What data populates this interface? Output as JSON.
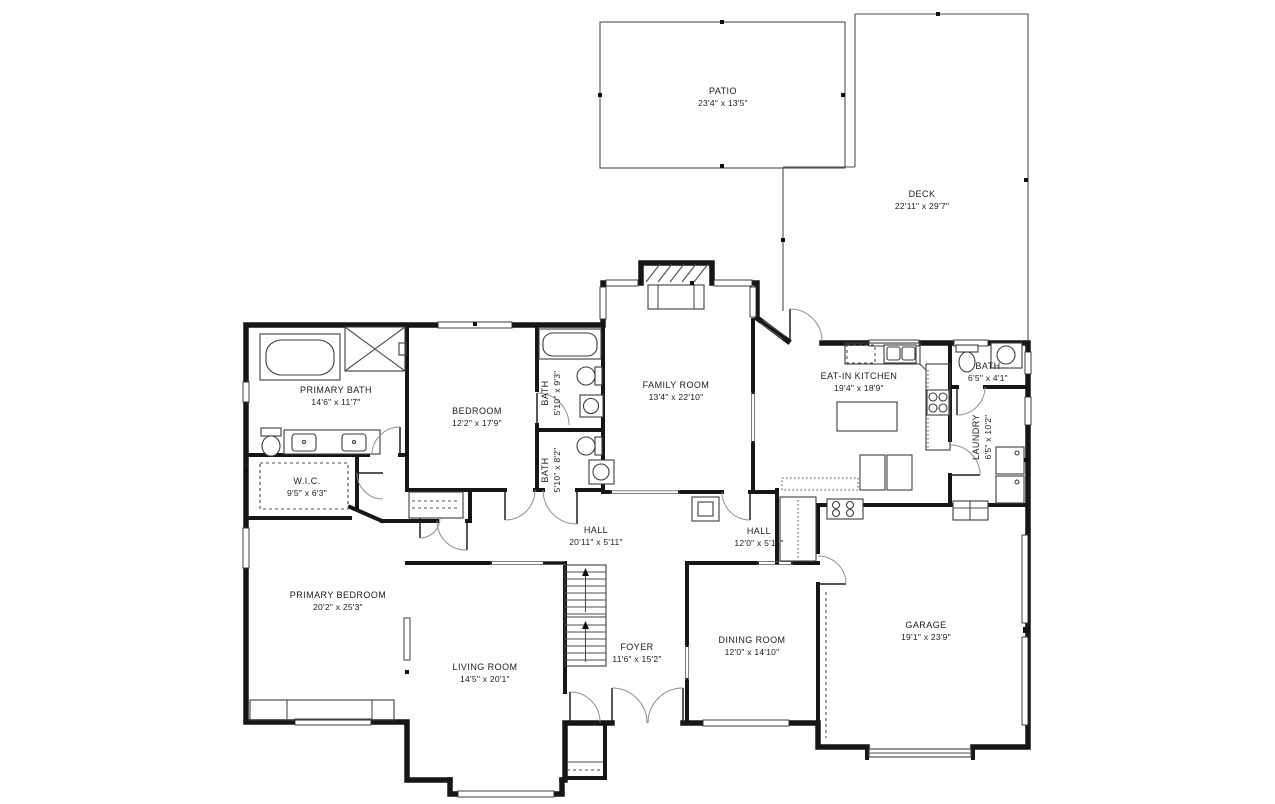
{
  "rooms": {
    "patio": {
      "name": "PATIO",
      "dims": "23'4\" x 13'5\""
    },
    "deck": {
      "name": "DECK",
      "dims": "22'11\" x 29'7\""
    },
    "primary_bath": {
      "name": "PRIMARY BATH",
      "dims": "14'6\" x 11'7\""
    },
    "wic": {
      "name": "W.I.C.",
      "dims": "9'5\" x 6'3\""
    },
    "bedroom": {
      "name": "BEDROOM",
      "dims": "12'2\" x 17'9\""
    },
    "bath_upper": {
      "name": "BATH",
      "dims": "5'10\" x 9'3\""
    },
    "bath_lower": {
      "name": "BATH",
      "dims": "5'10\" x 8'2\""
    },
    "family_room": {
      "name": "FAMILY ROOM",
      "dims": "13'4\" x 22'10\""
    },
    "eat_in_kitchen": {
      "name": "EAT-IN KITCHEN",
      "dims": "19'4\" x 18'9\""
    },
    "bath_right": {
      "name": "BATH",
      "dims": "6'5\" x 4'1\""
    },
    "laundry": {
      "name": "LAUNDRY",
      "dims": "6'5\" x 10'2\""
    },
    "hall_west": {
      "name": "HALL",
      "dims": "20'11\" x 5'11\""
    },
    "hall_east": {
      "name": "HALL",
      "dims": "12'0\" x 5'11\""
    },
    "primary_bedroom": {
      "name": "PRIMARY BEDROOM",
      "dims": "20'2\" x 25'3\""
    },
    "living_room": {
      "name": "LIVING ROOM",
      "dims": "14'5\" x 20'1\""
    },
    "foyer": {
      "name": "FOYER",
      "dims": "11'6\" x 15'2\""
    },
    "dining_room": {
      "name": "DINING ROOM",
      "dims": "12'0\" x 14'10\""
    },
    "garage": {
      "name": "GARAGE",
      "dims": "19'1\" x 23'9\""
    }
  },
  "colors": {
    "wall": "#161616",
    "background": "#ffffff",
    "thin_line": "#4f4f4f"
  }
}
